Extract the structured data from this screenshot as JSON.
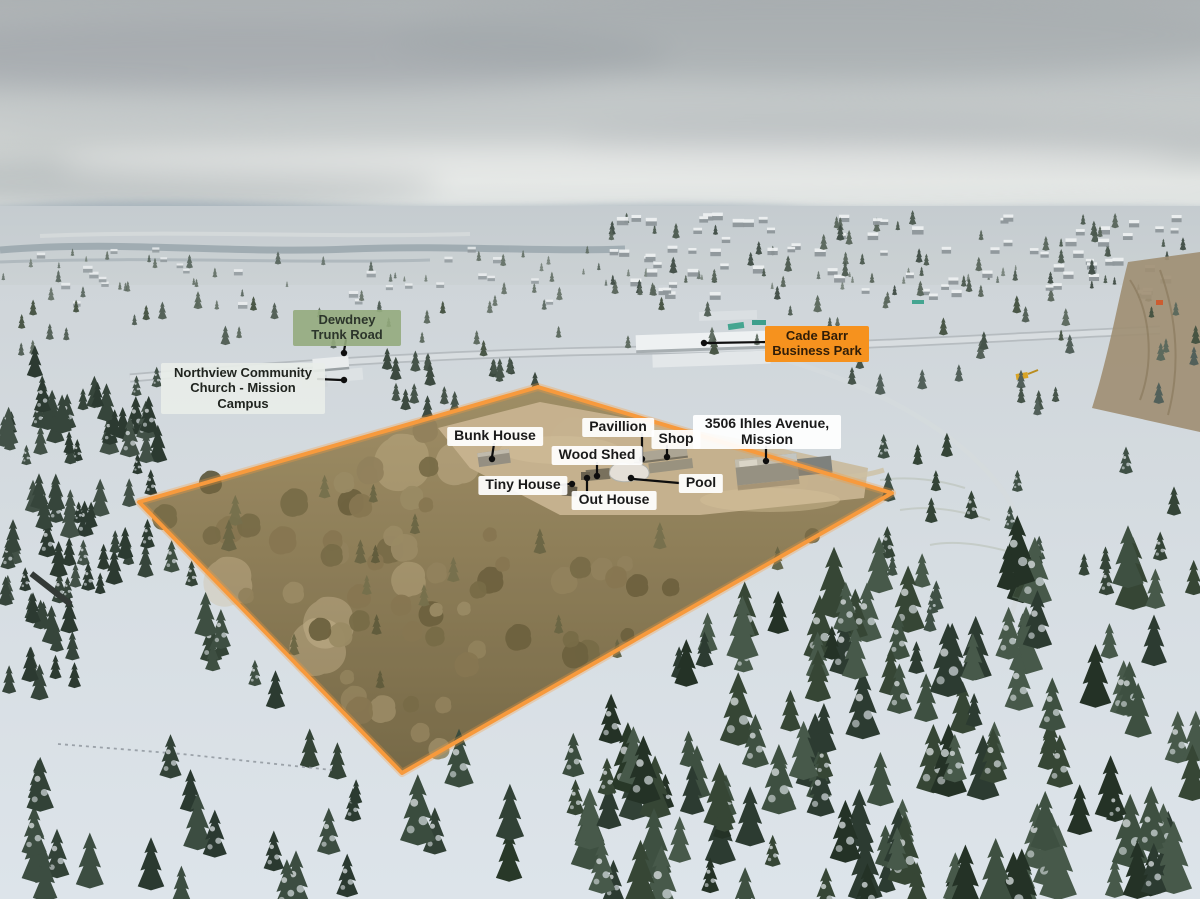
{
  "colors": {
    "boundary_line": "#F79A3D",
    "feature_label_bg": "#FFFFFF",
    "feature_label_text": "#1A1A1A",
    "road_label_bg": "#94AB7D",
    "church_label_bg": "#E9EDE9",
    "business_park_label_bg": "#F6921E"
  },
  "property": {
    "address": "3506 Ihles Avenue, Mission",
    "features": {
      "bunk_house": "Bunk House",
      "pavillion": "Pavillion",
      "shop": "Shop",
      "wood_shed": "Wood Shed",
      "tiny_house": "Tiny House",
      "out_house": "Out House",
      "pool": "Pool"
    }
  },
  "landmarks": {
    "road": "Dewdney Trunk Road",
    "church": "Northview Community Church - Mission Campus",
    "business_park": "Cade Barr Business Park"
  }
}
